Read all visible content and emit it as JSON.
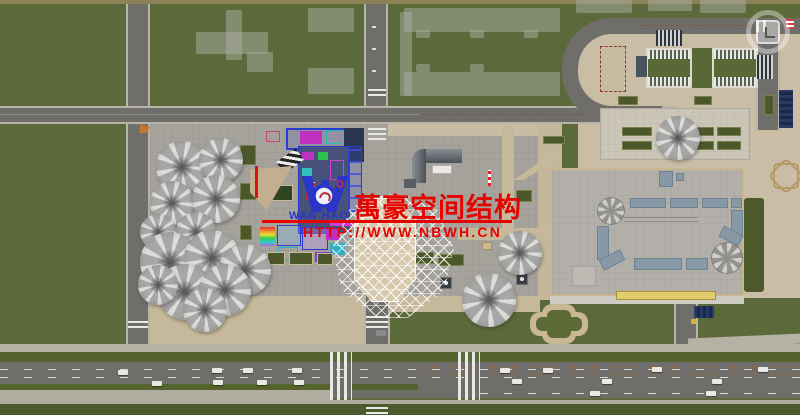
{
  "watermark": {
    "logo_text": "WAN HAO",
    "title_cn": "萬豪空间结构",
    "url": "HTTP://WWW.NBWH.CN",
    "color_red": "#e60400",
    "color_blue": "#2b36c8"
  },
  "overlay_icons": {
    "camera_watermark": "rounded-square-in-ring"
  },
  "palette": {
    "field_green": "#5c693a",
    "verge_green": "#4d5a2e",
    "road_asphalt": "#6f6e6b",
    "sidewalk": "#b9b4a8",
    "plaza_gray": "#a6a39d",
    "ground_tan": "#c9bca4",
    "roof_gray": "#b3b0aa",
    "skylight_blue": "#8799a6",
    "planter_green": "#4c5829",
    "roof_edge_yellow": "#e0cb6d"
  }
}
